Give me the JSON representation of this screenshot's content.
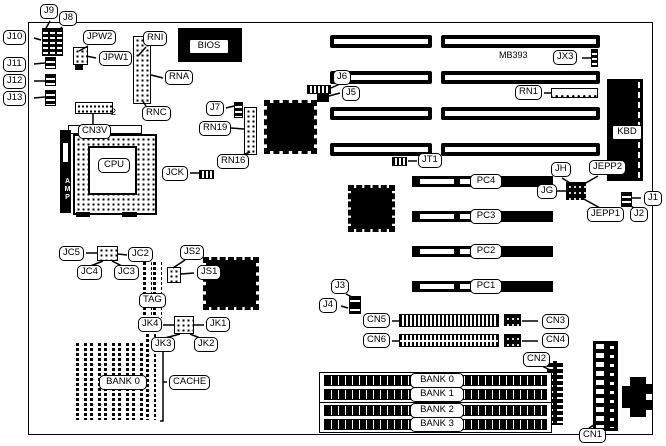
{
  "colors": {
    "ink": "#000000",
    "paper": "#ffffff"
  },
  "board": {
    "model": "MB393",
    "cpu": "CPU",
    "cpu_socket_brand": "AMP",
    "bios": "BIOS",
    "keyboard": "KBD",
    "cn3v_pin": "2"
  },
  "labels": {
    "j9": "J9",
    "j8": "J8",
    "j10": "J10",
    "j11": "J11",
    "j12": "J12",
    "j13": "J13",
    "jpw2": "JPW2",
    "jpw1": "JPW1",
    "rni": "RNI",
    "rna": "RNA",
    "rnc": "RNC",
    "cn3v": "CN3V",
    "j7": "J7",
    "rn19": "RN19",
    "rn16": "RN16",
    "jck": "JCK",
    "j6": "J6",
    "j5": "J5",
    "jt1": "JT1",
    "jx3": "JX3",
    "rn1": "RN1",
    "jh": "JH",
    "jg": "JG",
    "jepp2": "JEPP2",
    "jepp1": "JEPP1",
    "j1": "J1",
    "j2": "J2",
    "pc4": "PC4",
    "pc3": "PC3",
    "pc2": "PC2",
    "pc1": "PC1",
    "jc5": "JC5",
    "jc2": "JC2",
    "jc4": "JC4",
    "jc3": "JC3",
    "js2": "JS2",
    "js1": "JS1",
    "tag": "TAG",
    "jk4": "JK4",
    "jk1": "JK1",
    "jk3": "JK3",
    "jk2": "JK2",
    "cache_bank": "BANK 0",
    "cache": "CACHE",
    "j3": "J3",
    "j4": "J4",
    "cn5": "CN5",
    "cn6": "CN6",
    "cn3": "CN3",
    "cn4": "CN4",
    "cn2": "CN2",
    "cn1": "CN1"
  },
  "banks": [
    "BANK 0",
    "BANK 1",
    "BANK 2",
    "BANK 3"
  ]
}
